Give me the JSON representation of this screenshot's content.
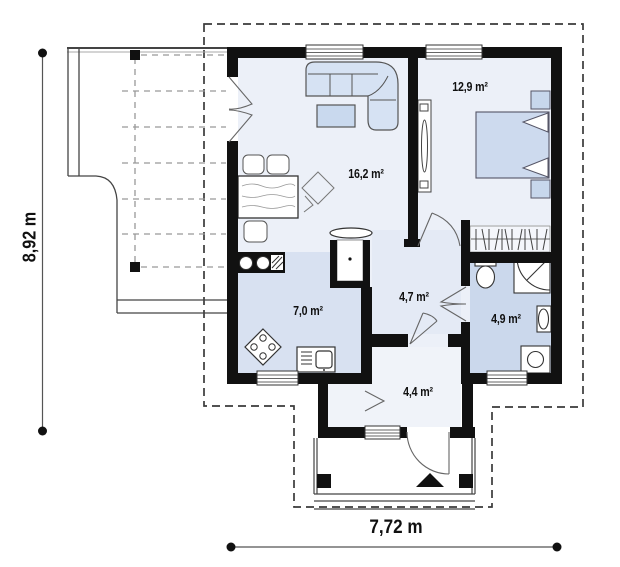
{
  "plan": {
    "type": "floor-plan",
    "rooms": [
      {
        "id": "living-room",
        "area_label": "16,2 m²"
      },
      {
        "id": "bedroom",
        "area_label": "12,9 m²"
      },
      {
        "id": "kitchen",
        "area_label": "7,0 m²"
      },
      {
        "id": "hall",
        "area_label": "4,7 m²"
      },
      {
        "id": "bathroom",
        "area_label": "4,9 m²"
      },
      {
        "id": "entry",
        "area_label": "4,4 m²"
      }
    ],
    "dimensions": {
      "height": "8,92 m",
      "width": "7,72 m"
    },
    "furniture_icons": [
      "corner-sofa",
      "coffee-table",
      "rug",
      "dining-table",
      "dining-chair",
      "fireplace",
      "kitchen-sink-counter",
      "cooktop",
      "counter-sink",
      "bed",
      "pillow",
      "nightstand",
      "tv-cabinet",
      "wardrobe-hangers",
      "toilet",
      "shower",
      "washbasin",
      "washing-machine",
      "entrance-arrow",
      "porch-post",
      "stairs",
      "window",
      "door-swing"
    ],
    "colors": {
      "wall": "#111111",
      "floor_light": "#ecf0f8",
      "floor_kitchen": "#d8e1f1",
      "floor_bathroom": "#cbd8ec",
      "floor_hall": "#e4eaf5",
      "floor_entry": "#f0f3f9",
      "floor_wardrobe": "#f4f6fb",
      "furniture_fill": "#d6e2f3",
      "bed_fill": "#cddaee",
      "outline": "#555555",
      "boundary_dash": "#3a3a3a",
      "grid_dash": "#999999"
    }
  }
}
